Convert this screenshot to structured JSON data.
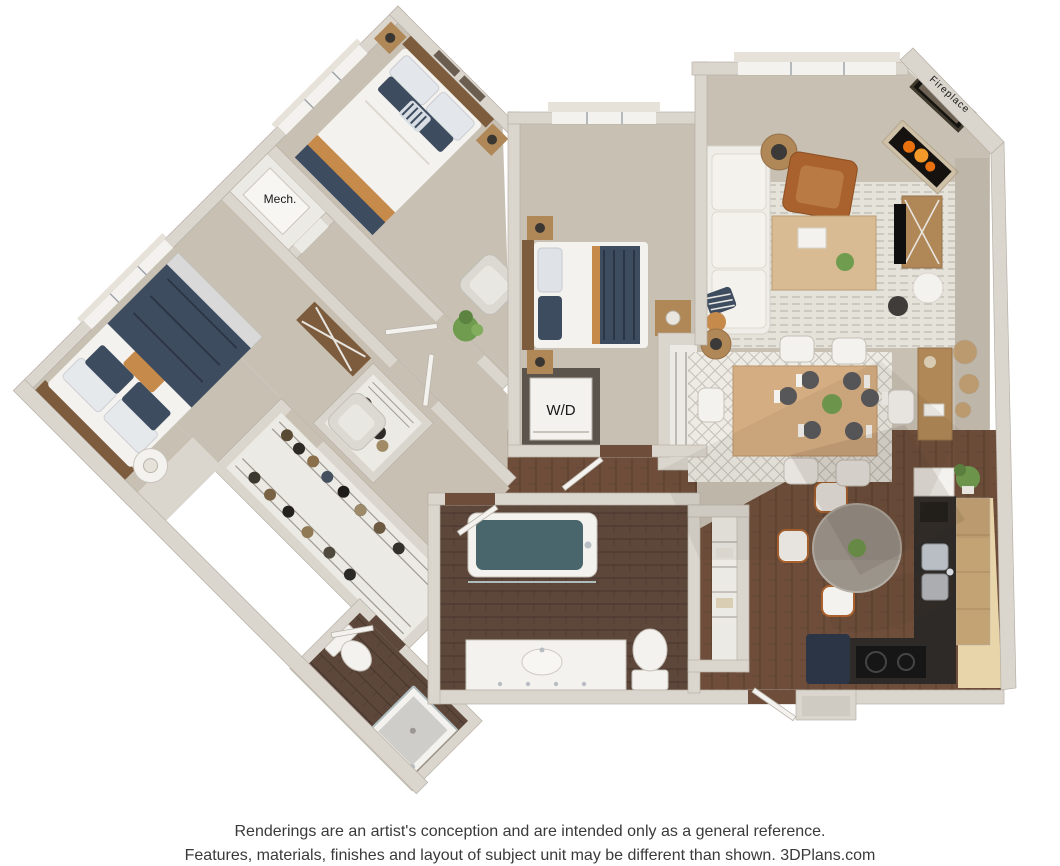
{
  "page": {
    "background": "#ffffff"
  },
  "plan": {
    "type": "3d-floor-plan-rendering",
    "labels": {
      "mech": "Mech.",
      "washer_dryer": "W/D",
      "fireplace": "Fireplace"
    },
    "rooms": [
      "bedroom-1",
      "bedroom-2",
      "bedroom-3",
      "mechanical-closet",
      "walk-in-closet",
      "small-closet",
      "coat-closet",
      "linen-closet",
      "laundry-closet",
      "main-bathroom",
      "shower-bathroom",
      "living-room",
      "dining-area",
      "kitchen",
      "breakfast-nook",
      "entry"
    ]
  },
  "disclaimer": {
    "line1": "Renderings are an artist's conception and are intended only as a general reference.",
    "line2": "Features, materials, finishes and layout of subject unit may be different than shown. 3DPlans.com"
  },
  "colors": {
    "pageBg": "#ffffff",
    "wall": "#dad5cd",
    "wallEdge": "#b7b0a6",
    "floorWhite": "#eceae5",
    "carpet": "#c7c0b3",
    "wood": "#6e4e3b",
    "woodBath": "#5d473b",
    "floorBeige": "#e8d5aa",
    "granite": "#2d2a27",
    "cabinet": "#c3a274",
    "rugLiving": "#e5e2da",
    "rugDining": "#edebe4",
    "navy": "#3e4c60",
    "navyDark": "#2c3545",
    "white": "#f4f2ee",
    "cream": "#e6e2da",
    "orange": "#c68a4b",
    "leather": "#a9612d",
    "green": "#6f9c4e",
    "chrome": "#b9bec4",
    "furnWood": "#b08756",
    "furnWoodDark": "#7d5c3e",
    "teal": "#49666d",
    "alcove": "#5a544d",
    "glass": "#aebcbe",
    "textDark": "#3a3a3a",
    "label": "#171717",
    "flame1": "#e8700f",
    "flame2": "#f2992a"
  }
}
